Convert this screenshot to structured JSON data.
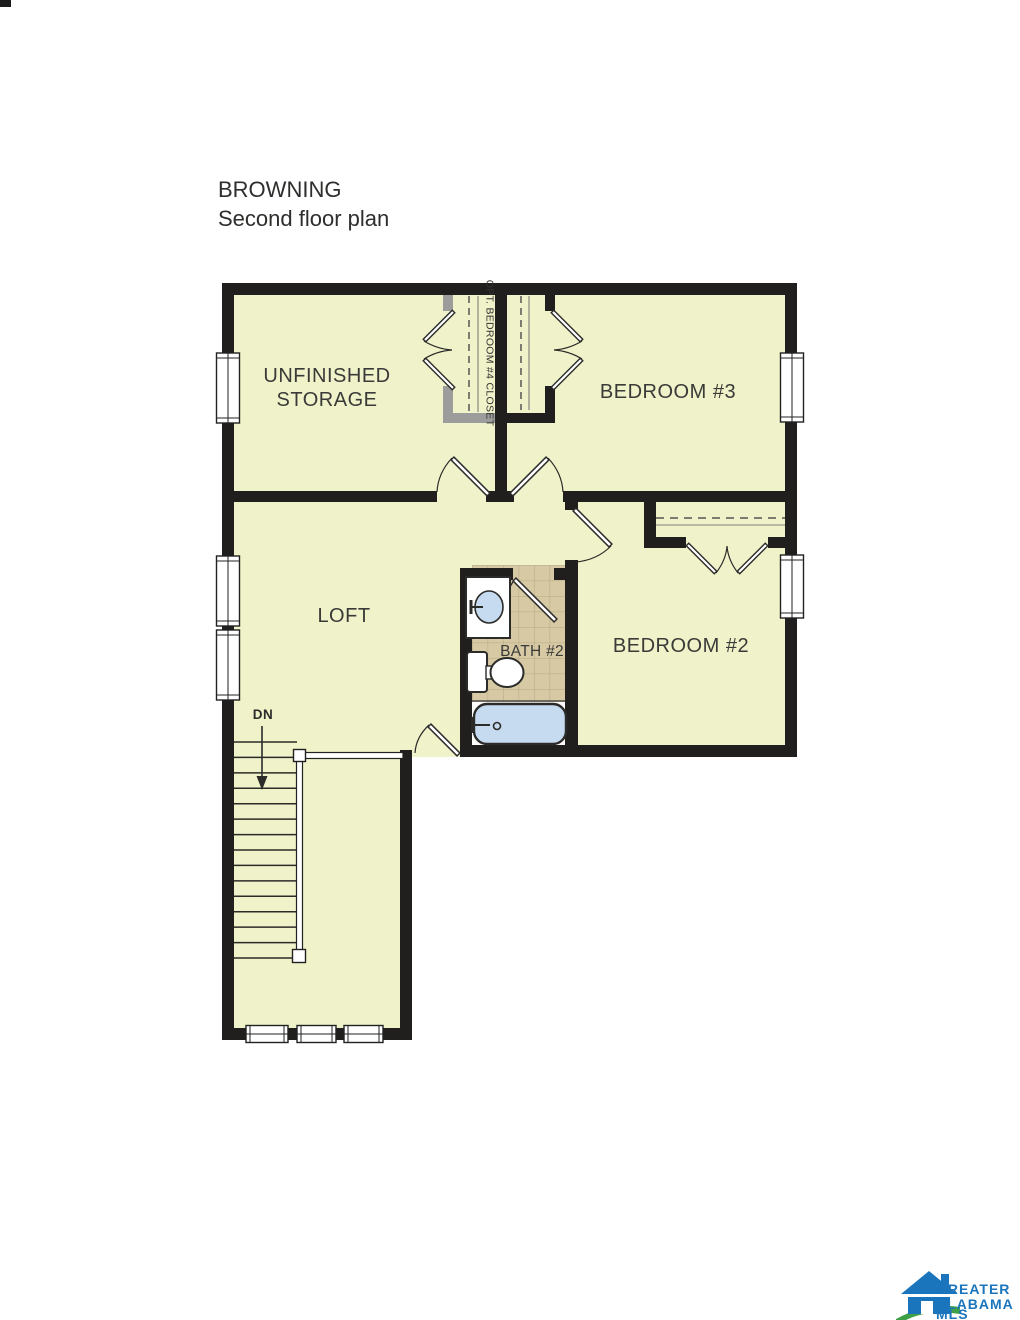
{
  "title": {
    "line1": "BROWNING",
    "line2": "Second floor plan"
  },
  "plan": {
    "rooms": [
      {
        "name": "unfinished-storage",
        "line1": "UNFINISHED",
        "line2": "STORAGE"
      },
      {
        "name": "bedroom-3",
        "label": "BEDROOM #3"
      },
      {
        "name": "loft",
        "label": "LOFT"
      },
      {
        "name": "bath-2",
        "label": "BATH #2"
      },
      {
        "name": "bedroom-2",
        "label": "BEDROOM #2"
      }
    ],
    "closet_label": "OPT. BEDROOM #4 CLOSET",
    "stairs": {
      "label": "DN",
      "direction": "down"
    },
    "colors": {
      "floor": "#f0f2ca",
      "wall": "#211e1e",
      "optional_wall": "#9c9c9c",
      "tile": "#d6c9a3",
      "tile_grid": "#bdae89",
      "fixture_blue": "#c7dbf0",
      "logo_blue": "#1b75bc",
      "logo_green": "#3fa047"
    }
  },
  "logo": {
    "line1": "GREATER",
    "line2": "ALABAMA",
    "line3": "MLS"
  }
}
